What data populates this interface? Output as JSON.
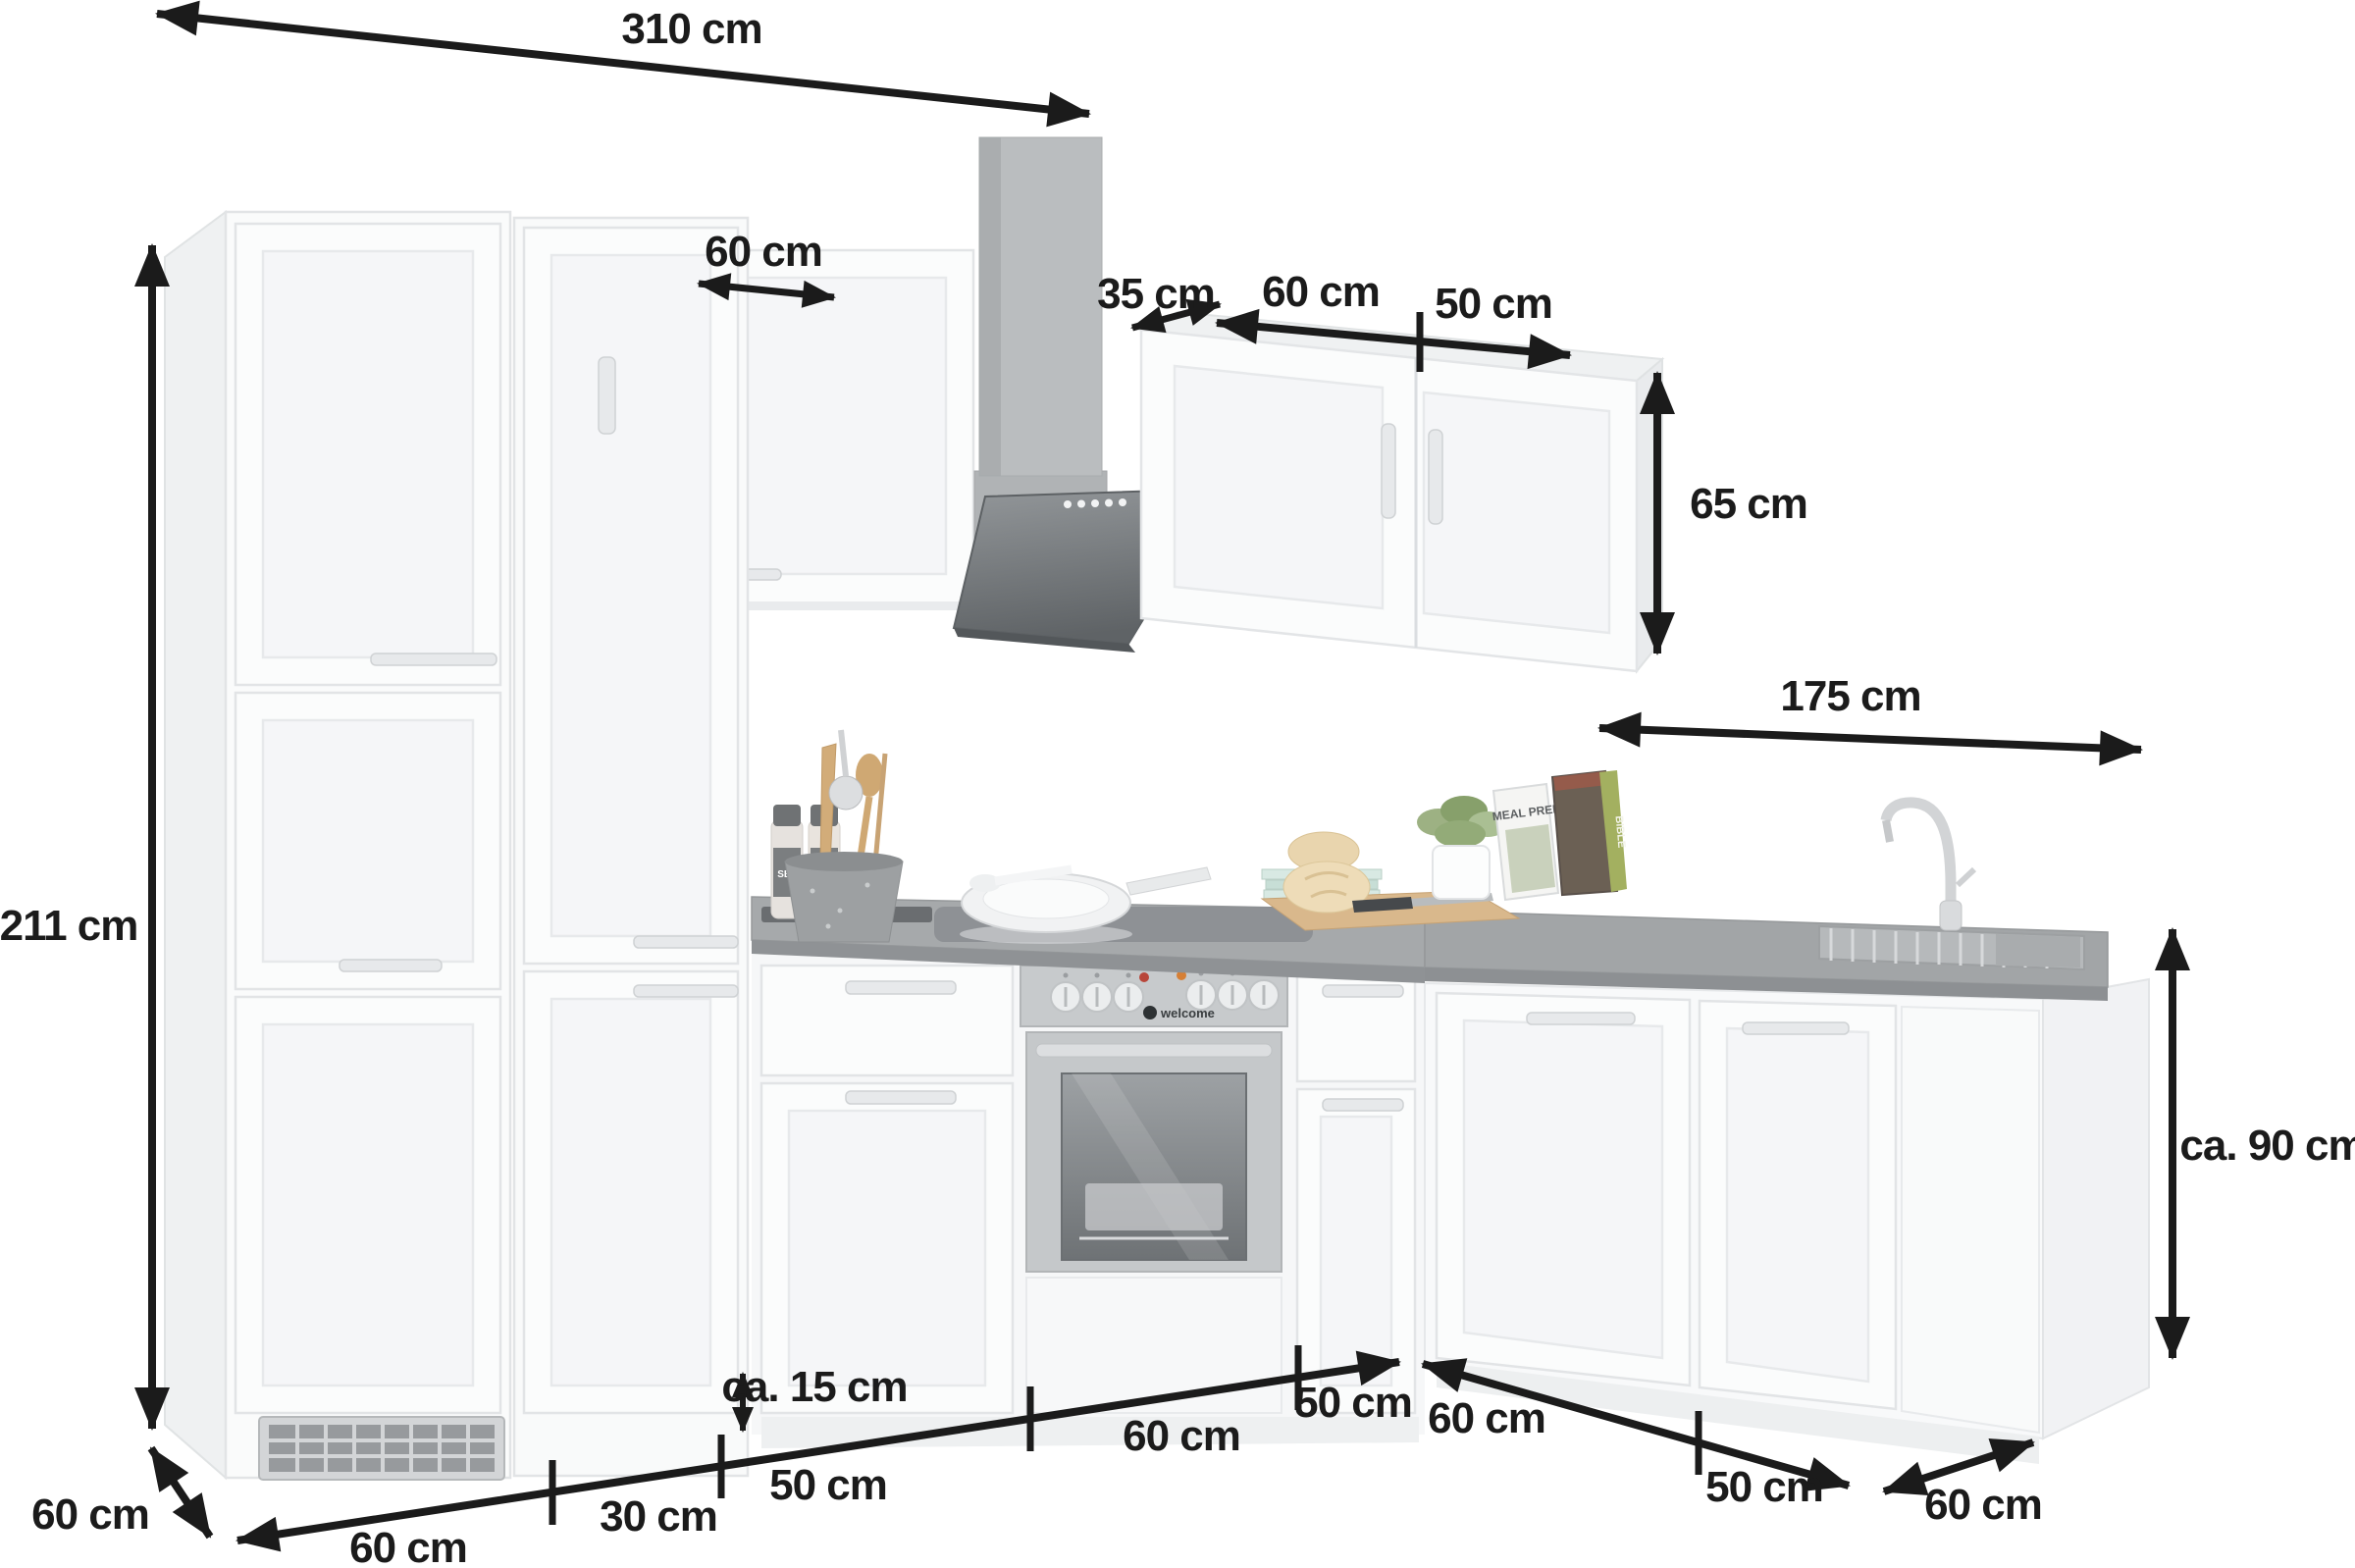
{
  "dimensions": {
    "total_width": "310 cm",
    "total_height": "211 cm",
    "left_wall_cabinet_width": "60 cm",
    "hood_clearance": "35 cm",
    "right_wall_cabinet_left_door": "60 cm",
    "right_wall_cabinet_right_door": "50 cm",
    "wall_cabinet_height": "65 cm",
    "right_run_width": "175 cm",
    "worktop_height": "ca. 90 cm",
    "plinth_height": "ca. 15 cm",
    "depth_left": "60 cm",
    "fridge_unit_width": "60 cm",
    "pullout_unit_width": "30 cm",
    "drawer_unit_width": "50 cm",
    "oven_unit_width": "60 cm",
    "right_of_oven_unit_width": "50 cm",
    "corner_unit_width": "60 cm",
    "sink_unit_width": "50 cm",
    "depth_right": "60 cm"
  },
  "decor": {
    "spice_jar": "SEL",
    "oven_brand": "welcome",
    "cookbook_front": "MEAL PREP",
    "cookbook_back": "BIBLE"
  },
  "colors": {
    "arrow": "#1b1b1b",
    "cabinet_white": "#fafbfb",
    "counter_gray": "#a6a9ab",
    "hood_gray": "#b7babc",
    "oven_steel": "#c7cacc"
  }
}
